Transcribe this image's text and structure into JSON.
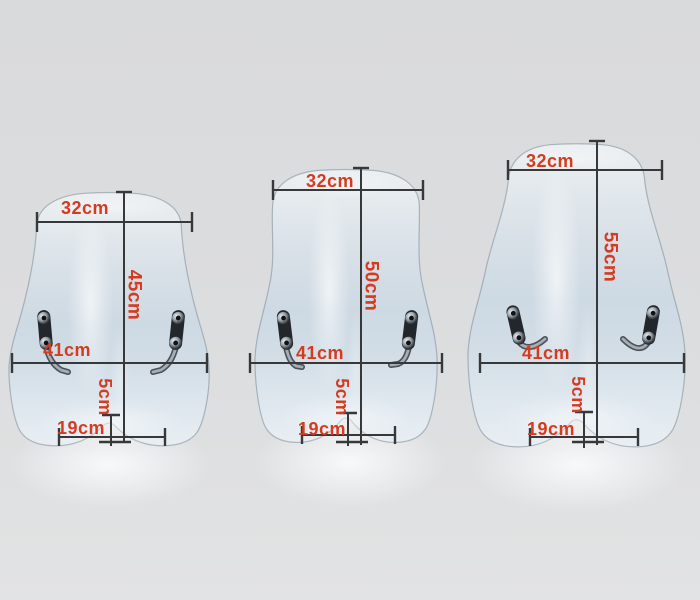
{
  "scene": {
    "description": "Three clear motorcycle windshields photographed with dimension annotations",
    "background_color": "#dcddde",
    "dimension_line_color": "#36383a",
    "label_color": "#d43b20"
  },
  "windshields": [
    {
      "id": "windshield-45",
      "top_width": "32cm",
      "height": "45cm",
      "mount_width": "41cm",
      "base_width": "19cm",
      "base_offset": "5cm"
    },
    {
      "id": "windshield-50",
      "top_width": "32cm",
      "height": "50cm",
      "mount_width": "41cm",
      "base_width": "19cm",
      "base_offset": "5cm"
    },
    {
      "id": "windshield-55",
      "top_width": "32cm",
      "height": "55cm",
      "mount_width": "41cm",
      "base_width": "19cm",
      "base_offset": "5cm"
    }
  ]
}
